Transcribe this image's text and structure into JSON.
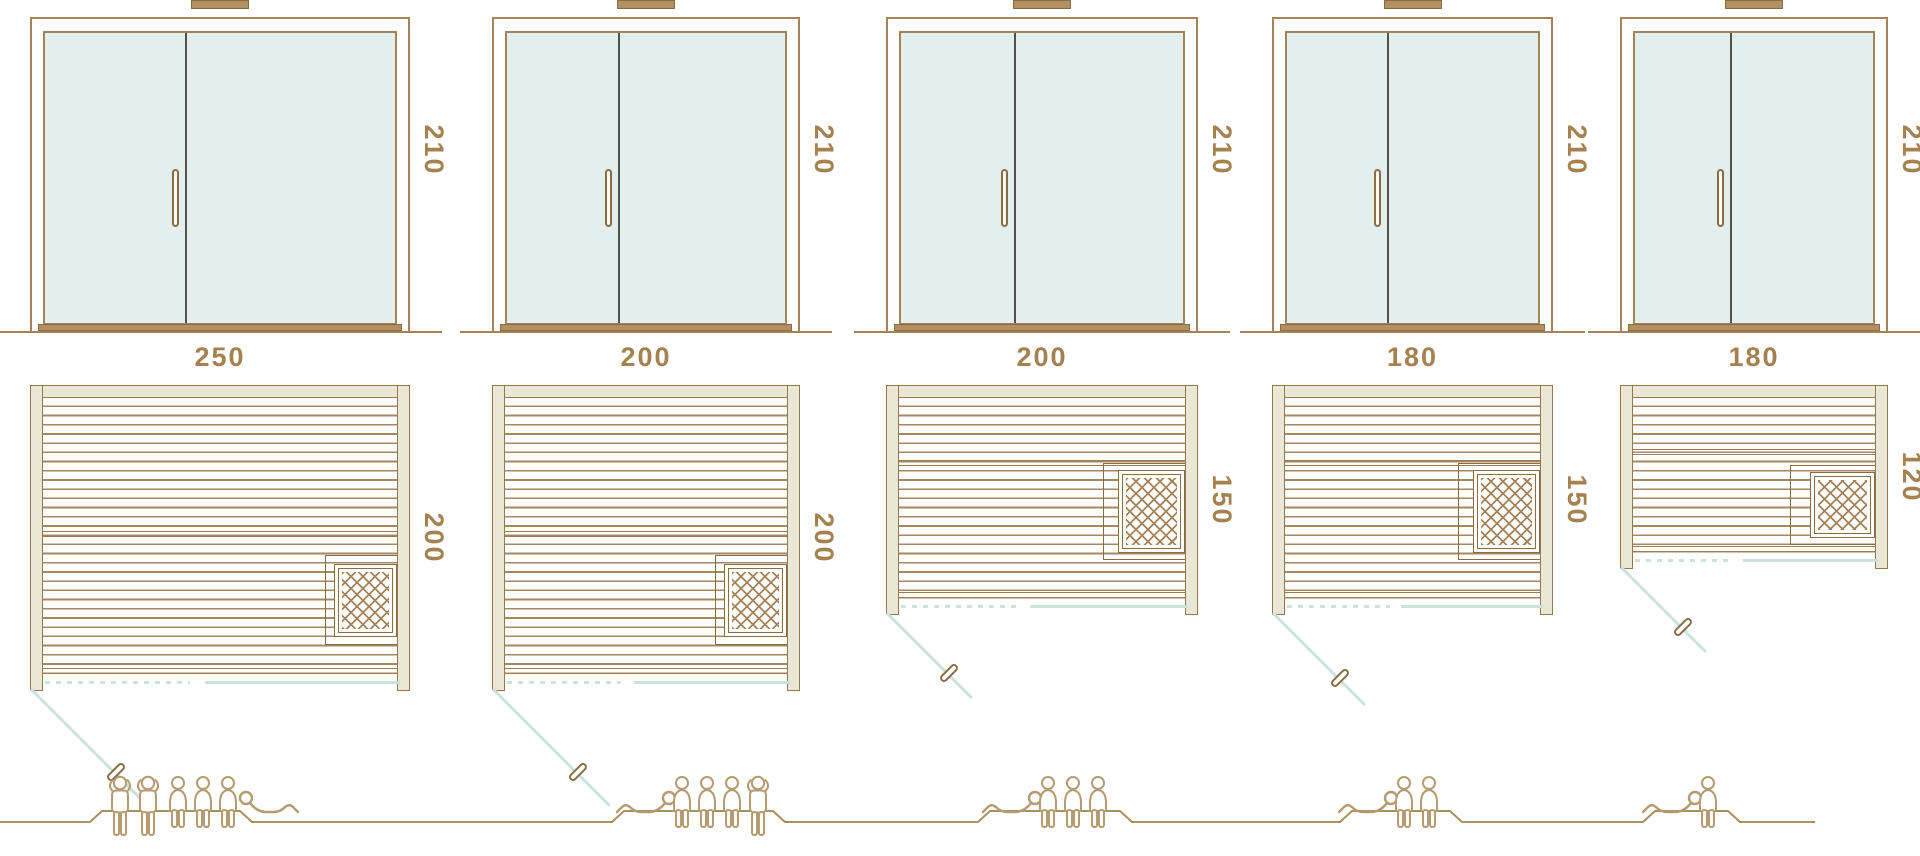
{
  "title": "Sauna size comparison diagram — door elevations, floor plans and capacities",
  "colors": {
    "line": "#a5835a",
    "dark": "#8a6b42",
    "text": "#a5814f",
    "wall_fill": "#eae7d6",
    "glass": "#e2efec",
    "teal": "#cbe3dd",
    "plank": "#a58760",
    "people": "#b49b71",
    "divider": "#57504a",
    "vent": "#b39064"
  },
  "saunas": [
    {
      "id": 1,
      "door_height_label": "210",
      "width_label": "250",
      "depth_label": "200",
      "capacity": {
        "standing": 2,
        "seated": 3,
        "lying": 1,
        "total": 6
      },
      "people": [
        "standing",
        "standing",
        "seated",
        "seated",
        "seated",
        "lying"
      ],
      "layout": {
        "left": 30,
        "width": 380,
        "plan_h": 306,
        "band_pct": 48,
        "swing": 165,
        "nook": {
          "x": 295,
          "y": 170,
          "w": 72,
          "h": 90
        },
        "heater": {
          "x": 304,
          "y": 179,
          "w": 63,
          "h": 73
        },
        "figures": [
          {
            "t": "standing",
            "x": 106
          },
          {
            "t": "standing",
            "x": 134
          },
          {
            "t": "seated",
            "x": 162
          },
          {
            "t": "seated",
            "x": 187
          },
          {
            "t": "seated",
            "x": 212
          },
          {
            "t": "lying",
            "x": 237,
            "mirror": true
          }
        ],
        "plateau": [
          90,
          102,
          240,
          252
        ]
      }
    },
    {
      "id": 2,
      "door_height_label": "210",
      "width_label": "200",
      "depth_label": "200",
      "capacity": {
        "standing": 1,
        "seated": 3,
        "lying": 1,
        "total": 5
      },
      "people": [
        "lying",
        "seated",
        "seated",
        "seated",
        "standing"
      ],
      "layout": {
        "left": 492,
        "width": 308,
        "plan_h": 306,
        "band_pct": 48,
        "swing": 165,
        "nook": {
          "x": 223,
          "y": 170,
          "w": 72,
          "h": 90
        },
        "heater": {
          "x": 232,
          "y": 179,
          "w": 63,
          "h": 73
        },
        "figures": [
          {
            "t": "lying",
            "x": 614
          },
          {
            "t": "seated",
            "x": 666
          },
          {
            "t": "seated",
            "x": 691
          },
          {
            "t": "seated",
            "x": 716
          },
          {
            "t": "standing",
            "x": 744
          }
        ],
        "plateau": [
          612,
          624,
          773,
          785
        ]
      }
    },
    {
      "id": 3,
      "door_height_label": "210",
      "width_label": "200",
      "depth_label": "150",
      "capacity": {
        "standing": 0,
        "seated": 3,
        "lying": 1,
        "total": 4
      },
      "people": [
        "lying",
        "seated",
        "seated",
        "seated"
      ],
      "layout": {
        "left": 886,
        "width": 312,
        "plan_h": 230,
        "band_pct": 31,
        "swing": 120,
        "nook": {
          "x": 217,
          "y": 78,
          "w": 82,
          "h": 97
        },
        "heater": {
          "x": 232,
          "y": 85,
          "w": 67,
          "h": 83
        },
        "figures": [
          {
            "t": "lying",
            "x": 980
          },
          {
            "t": "seated",
            "x": 1032
          },
          {
            "t": "seated",
            "x": 1057
          },
          {
            "t": "seated",
            "x": 1082
          }
        ],
        "plateau": [
          978,
          990,
          1120,
          1132
        ]
      }
    },
    {
      "id": 4,
      "door_height_label": "210",
      "width_label": "180",
      "depth_label": "150",
      "capacity": {
        "standing": 0,
        "seated": 2,
        "lying": 1,
        "total": 3
      },
      "people": [
        "lying",
        "seated",
        "seated"
      ],
      "layout": {
        "left": 1272,
        "width": 281,
        "plan_h": 230,
        "band_pct": 31,
        "swing": 130,
        "nook": {
          "x": 186,
          "y": 78,
          "w": 82,
          "h": 97
        },
        "heater": {
          "x": 201,
          "y": 85,
          "w": 67,
          "h": 83
        },
        "figures": [
          {
            "t": "lying",
            "x": 1336
          },
          {
            "t": "seated",
            "x": 1388
          },
          {
            "t": "seated",
            "x": 1413
          }
        ],
        "plateau": [
          1340,
          1352,
          1450,
          1462
        ]
      }
    },
    {
      "id": 5,
      "door_height_label": "210",
      "width_label": "180",
      "depth_label": "120",
      "capacity": {
        "standing": 0,
        "seated": 1,
        "lying": 1,
        "total": 2
      },
      "people": [
        "lying",
        "seated"
      ],
      "layout": {
        "left": 1620,
        "width": 268,
        "plan_h": 184,
        "band_pct": 33,
        "swing": 120,
        "nook": {
          "x": 170,
          "y": 80,
          "w": 85,
          "h": 80
        },
        "heater": {
          "x": 190,
          "y": 87,
          "w": 65,
          "h": 66
        },
        "figures": [
          {
            "t": "lying",
            "x": 1640
          },
          {
            "t": "seated",
            "x": 1692
          }
        ],
        "plateau": [
          1643,
          1655,
          1728,
          1740
        ]
      }
    }
  ],
  "people_row": {
    "baseline_y": 52,
    "plateau_y": 41,
    "start_x": 0,
    "end_x": 1815
  }
}
